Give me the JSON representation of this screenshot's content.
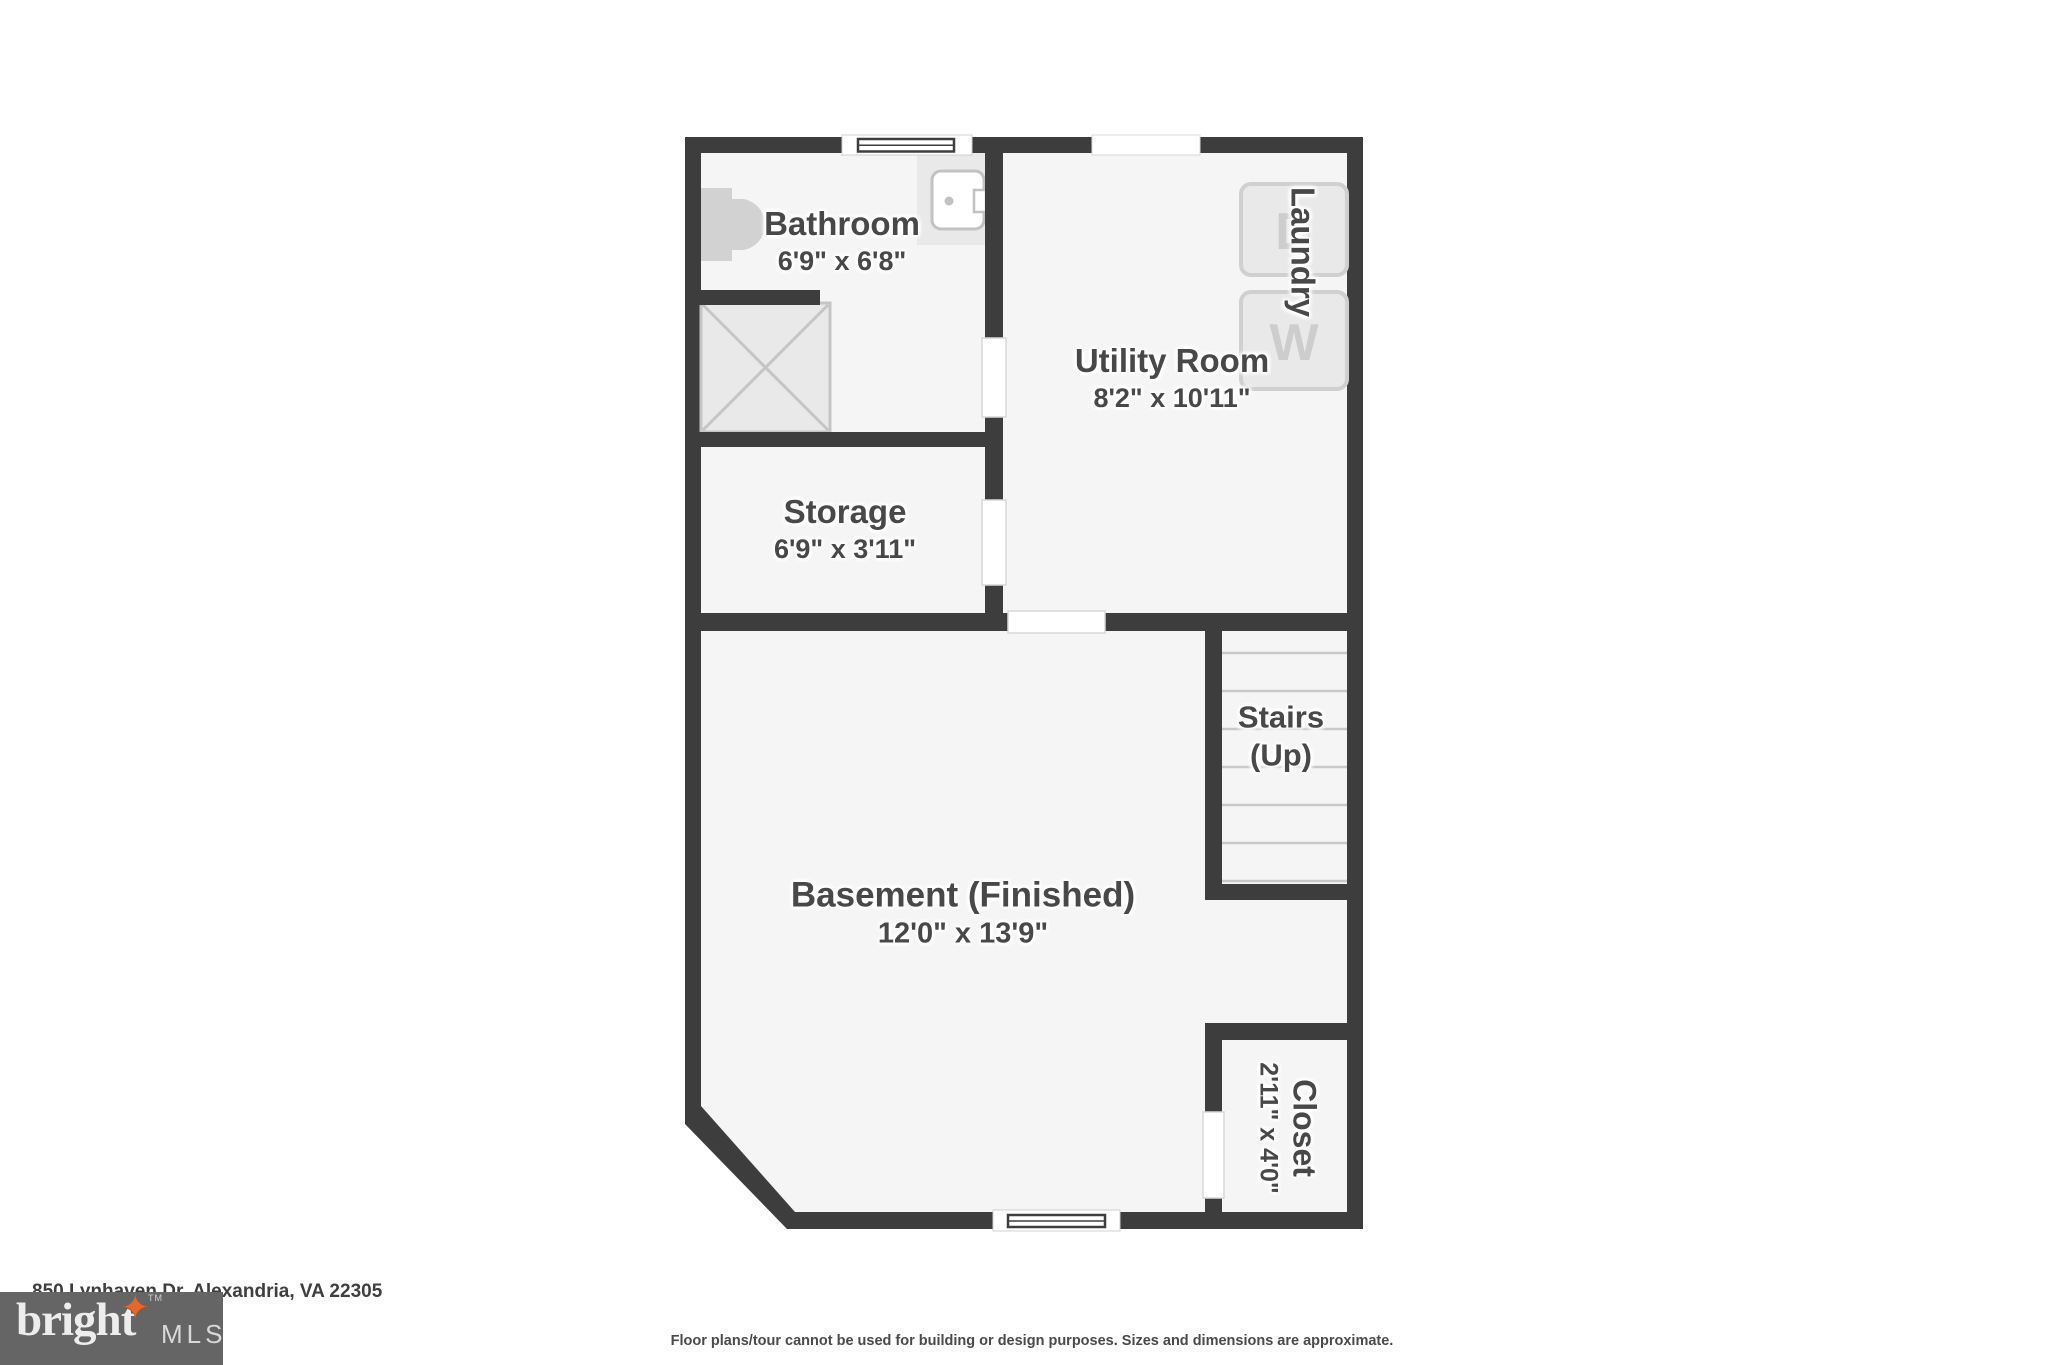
{
  "floorplan": {
    "rooms": {
      "bathroom": {
        "name": "Bathroom",
        "dims": "6'9\" x 6'8\""
      },
      "utility_room": {
        "name": "Utility Room",
        "dims": "8'2\" x 10'11\""
      },
      "laundry": {
        "name": "Laundry"
      },
      "storage": {
        "name": "Storage",
        "dims": "6'9\" x 3'11\""
      },
      "stairs": {
        "name": "Stairs",
        "direction": "(Up)"
      },
      "basement": {
        "name": "Basement (Finished)",
        "dims": "12'0\" x 13'9\""
      },
      "closet": {
        "name": "Closet",
        "dims": "2'11\" x 4'0\""
      }
    },
    "appliances": {
      "washer_label": "W",
      "dryer_label": "D"
    }
  },
  "footer": {
    "address": "850 Lynhaven Dr, Alexandria, VA 22305",
    "disclaimer": "Floor plans/tour cannot be used for building or design purposes. Sizes and dimensions are approximate."
  },
  "logo": {
    "brand": "bright",
    "tm": "TM",
    "suffix": "MLS"
  },
  "colors": {
    "wall": "#3d3d3d",
    "floor": "#f5f5f5",
    "fixture": "#e9e9e9",
    "accent_star": "#e2682e"
  }
}
